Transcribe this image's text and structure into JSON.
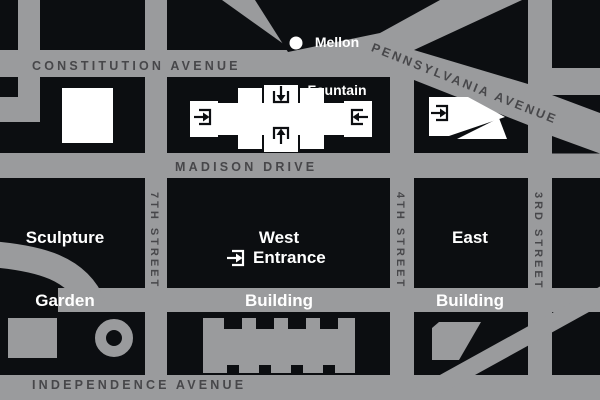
{
  "streets": {
    "constitution": "CONSTITUTION AVENUE",
    "pennsylvania": "PENNSYLVANIA AVENUE",
    "madison": "MADISON DRIVE",
    "independence": "INDEPENDENCE AVENUE",
    "seventh": "7TH STREET",
    "fourth": "4TH STREET",
    "third": "3RD STREET"
  },
  "labels": {
    "mellon_line1": "Mellon",
    "mellon_line2": "Fountain",
    "sculpture_line1": "Sculpture",
    "sculpture_line2": "Garden",
    "west_line1": "West",
    "west_line2": "Building",
    "east_line1": "East",
    "east_line2": "Building",
    "entrance": "Entrance"
  },
  "icons": {
    "entry_icon": "arrow-into-bracket",
    "fountain_marker": "white-dot"
  },
  "colors": {
    "street_gray": "#9a9b9d",
    "block_black": "#0c0e11",
    "street_text": "#47474a",
    "building_white": "#ffffff"
  }
}
